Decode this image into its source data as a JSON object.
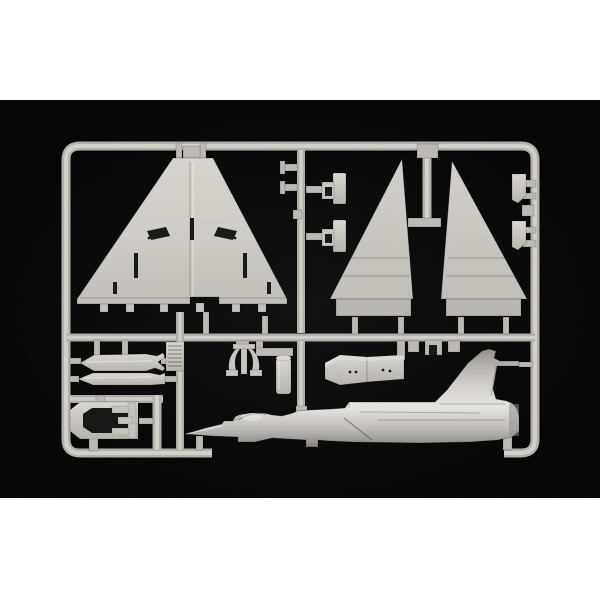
{
  "scene": {
    "type": "product-photograph",
    "description": "Studio photo of a light gray injection-molded model kit sprue (plastic parts tree) for a delta-wing jet fighter, centered on a black background with white bands above and below",
    "photo_background": "#020202",
    "page_background": "#ffffff"
  },
  "colors": {
    "page_background": "#ffffff",
    "photo_background": "#020202",
    "plastic_base": "#cbc8c2",
    "plastic_highlight": "#e7e5e0",
    "plastic_shadow": "#8f8c87",
    "recess_dark": "#161614"
  },
  "parts": [
    {
      "name": "delta-wing",
      "description": "one-piece delta wing panel with elevon slots and hinge tabs along the trailing edge"
    },
    {
      "name": "vertical-stabilizer-left",
      "description": "tall swept tail-fin half with thick root band"
    },
    {
      "name": "vertical-stabilizer-right",
      "description": "tall swept tail-fin half, mirrored"
    },
    {
      "name": "fuselage-half",
      "description": "fuselage half in side view with pointed nose cone, canopy, intake and integral vertical tail"
    },
    {
      "name": "drop-tank-half-upper",
      "description": "long external fuel-tank half with forked tail fins"
    },
    {
      "name": "drop-tank-half-lower",
      "description": "slimmer external fuel-tank half"
    },
    {
      "name": "gear-door-left-pair",
      "description": "two small landing-gear door/bracket parts on inner left runner"
    },
    {
      "name": "gear-door-right-pair",
      "description": "two small landing-gear door/bracket parts on right frame rail"
    },
    {
      "name": "intake-ramp-pair",
      "description": "two stepped air-intake ramp blocks with locating holes"
    },
    {
      "name": "wheel-bay",
      "description": "boxed wheel-bay part with dark cavity and E-shaped bracket"
    },
    {
      "name": "pylon",
      "description": "twin curved-leg pylon part hanging from mid runner"
    },
    {
      "name": "exhaust-ladder-section",
      "description": "small ribbed ladder-like section on vertical runner"
    },
    {
      "name": "tank-nose-cylinder",
      "description": "small cylinder with domed cap"
    },
    {
      "name": "sprue-frame",
      "description": "rounded rectangular runner frame with mid rail, vertical runners, gates and stubs"
    }
  ]
}
